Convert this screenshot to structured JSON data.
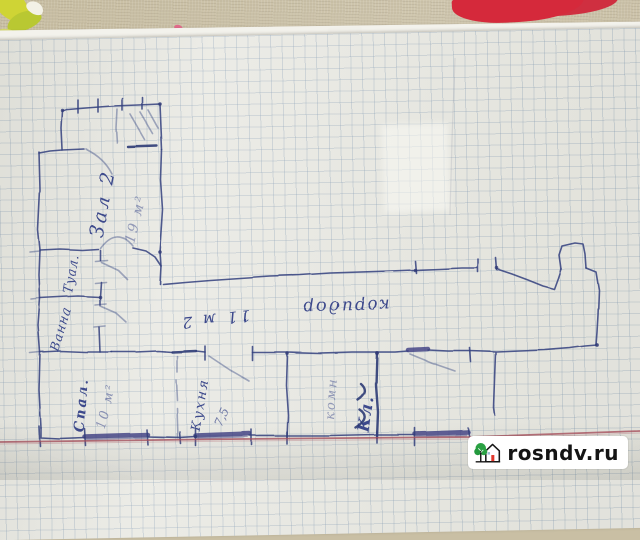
{
  "photo": {
    "description": "hand-drawn apartment floor plan on squared notebook paper",
    "watermark": {
      "text": "rosndv.ru"
    },
    "colors": {
      "ink": "#3c4a8c",
      "red_baseline": "#a8505e",
      "fabric": "#c9bfa4",
      "leaf_pattern": "#cfd435",
      "red_fabric_blob": "#d5293b",
      "watermark_bg": "#ffffff",
      "watermark_text": "#141414",
      "logo_tree": "#2aa143",
      "logo_door": "#e2362b"
    }
  },
  "floor_plan": {
    "rooms": [
      {
        "label": "Зал 2",
        "area": "19 м²"
      },
      {
        "label": "Туал."
      },
      {
        "label": "Ванна"
      },
      {
        "label": "коридор",
        "area": "11 м 2"
      },
      {
        "label": "Спал.",
        "area": "10 м²"
      },
      {
        "label": "Кухня",
        "area": "7,5"
      },
      {
        "label": "комн"
      },
      {
        "label": "Кл."
      }
    ]
  }
}
